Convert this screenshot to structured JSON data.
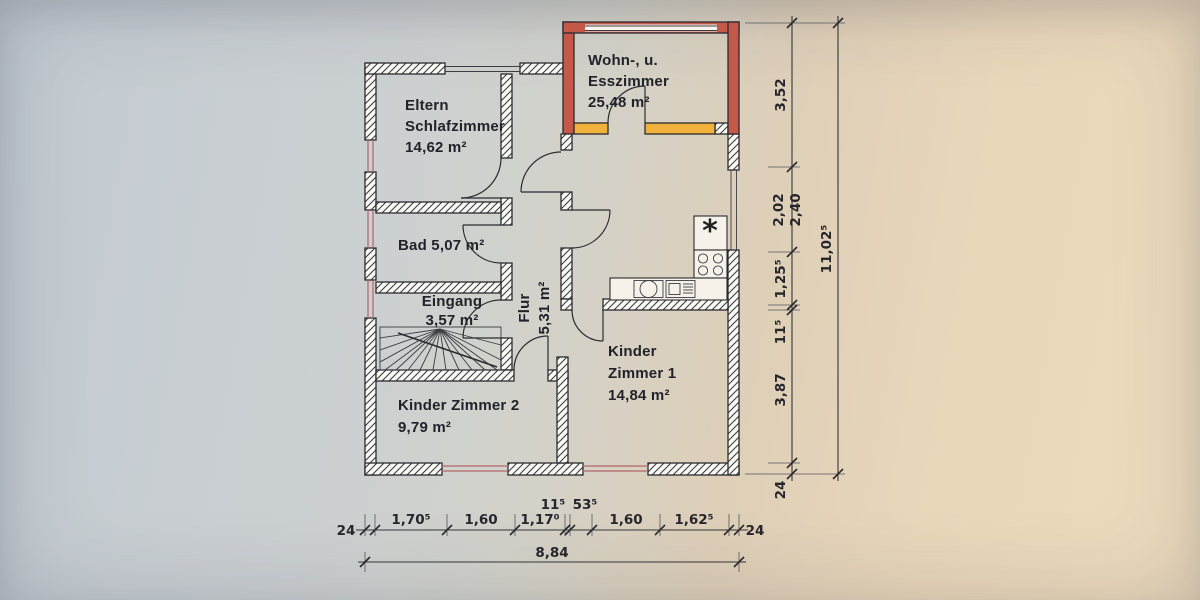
{
  "title": "Grundriss Obergeschoss (scan)",
  "rooms": {
    "wohn_esszimmer": {
      "line1": "Wohn-, u.",
      "line2": "Esszimmer",
      "area": "25,48 m²"
    },
    "eltern": {
      "line1": "Eltern",
      "line2": "Schlafzimmer",
      "area": "14,62 m²"
    },
    "bad": {
      "label": "Bad 5,07 m²"
    },
    "eingang": {
      "name": "Eingang",
      "area": "3,57 m²"
    },
    "flur": {
      "name": "Flur",
      "area": "5,31 m²"
    },
    "kinder1": {
      "line1": "Kinder",
      "line2": "Zimmer 1",
      "area": "14,84 m²"
    },
    "kinder2": {
      "name": "Kinder Zimmer 2",
      "area": "9,79 m²"
    }
  },
  "dims": {
    "bottom": {
      "wall_left": "24",
      "seg1": "1,70⁵",
      "seg2": "1,60",
      "seg3": "1,17⁰",
      "seg4": "11⁵",
      "seg5": "53⁵",
      "seg6": "1,60",
      "seg7": "1,62⁵",
      "wall_right": "24",
      "total": "8,84"
    },
    "right": {
      "seg1": "3,52",
      "seg2a": "2,02",
      "seg2b": "2,40",
      "seg3": "1,25⁵",
      "seg4": "11⁵",
      "seg5": "3,87",
      "wall_bottom": "24",
      "total": "11,02⁵"
    }
  },
  "icons": {
    "freezer_star": "*"
  },
  "colors": {
    "new_wall_red": "#c4594a",
    "old_wall_orange": "#f0b23c",
    "paper_left": "#c8ced2",
    "paper_right": "#ecdabd"
  }
}
